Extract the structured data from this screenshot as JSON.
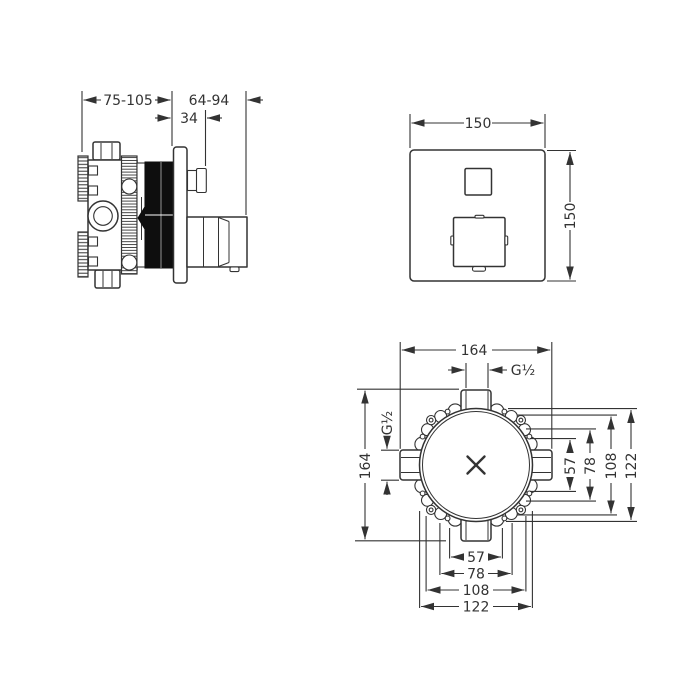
{
  "colors": {
    "line": "#333333",
    "solid_fill": "#0e0e0e",
    "background": "#ffffff"
  },
  "side_view": {
    "dim_mount_depth": "75-105",
    "dim_trim_depth": "64-94",
    "dim_plate_depth": "34"
  },
  "front_view": {
    "dim_width": "150",
    "dim_height": "150"
  },
  "plan_view": {
    "dim_width": "164",
    "dim_height": "164",
    "top_port_thread": "G½",
    "left_port_thread": "G½",
    "right_dims": [
      "57",
      "78",
      "108",
      "122"
    ],
    "bottom_dims": [
      "57",
      "78",
      "108",
      "122"
    ]
  }
}
